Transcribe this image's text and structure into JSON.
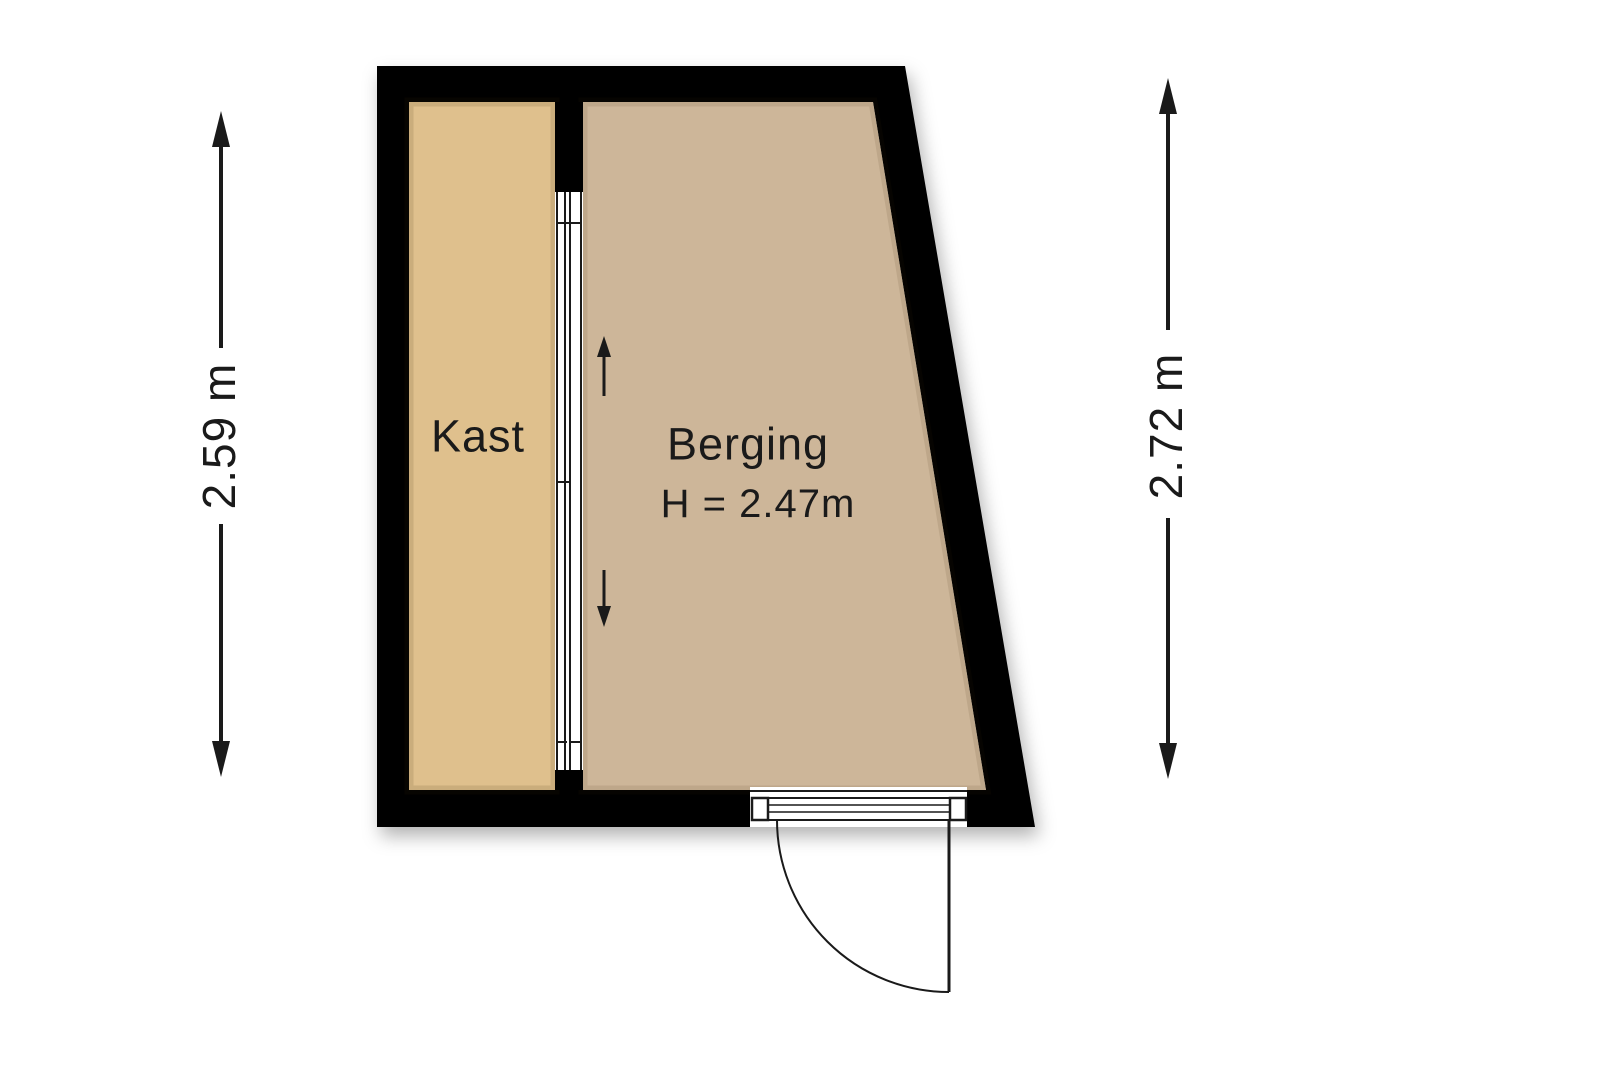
{
  "floorplan": {
    "rooms": [
      {
        "name": "Kast",
        "fill": "#dfc08d"
      },
      {
        "name": "Berging",
        "fill": "#cdb699",
        "height_label": "H = 2.47m"
      }
    ],
    "dimensions": {
      "left_label": "2.59 m",
      "right_label": "2.72 m"
    },
    "colors": {
      "wall": "#000000",
      "line": "#1a1a1a",
      "text": "#1a1a1a"
    }
  }
}
